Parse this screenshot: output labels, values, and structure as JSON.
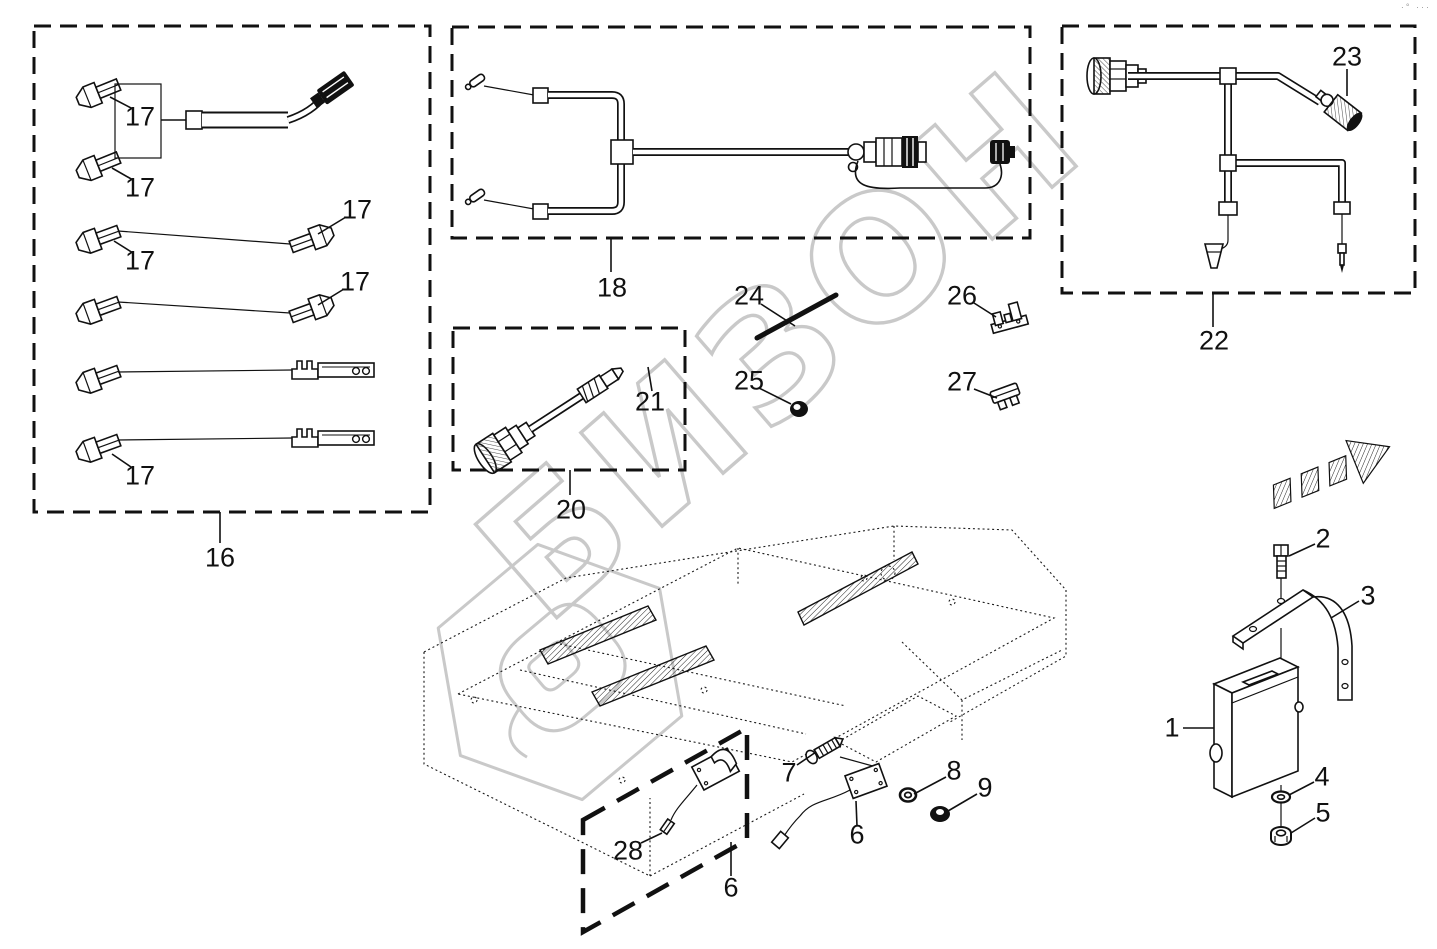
{
  "meta": {
    "watermark_text": "БИЗОН",
    "corner_mark": "·° ···",
    "line_color": "#111111",
    "watermark_color": "#c9c9c9"
  },
  "callouts": {
    "module": "1",
    "screw": "2",
    "bracket": "3",
    "washer": "4",
    "nut": "5",
    "sensor_box": "6",
    "sensor_plate": "6",
    "screw_small": "7",
    "washer_small": "8",
    "nut_small": "9",
    "cable_kit_box": "16",
    "terminal": "17",
    "y_harness_box": "18",
    "adapter_box": "20",
    "adapter_plug": "21",
    "main_harness_box": "22",
    "round_plug": "23",
    "rod": "24",
    "grommet": "25",
    "clip": "26",
    "fuse": "27",
    "sensor_connector": "28"
  }
}
